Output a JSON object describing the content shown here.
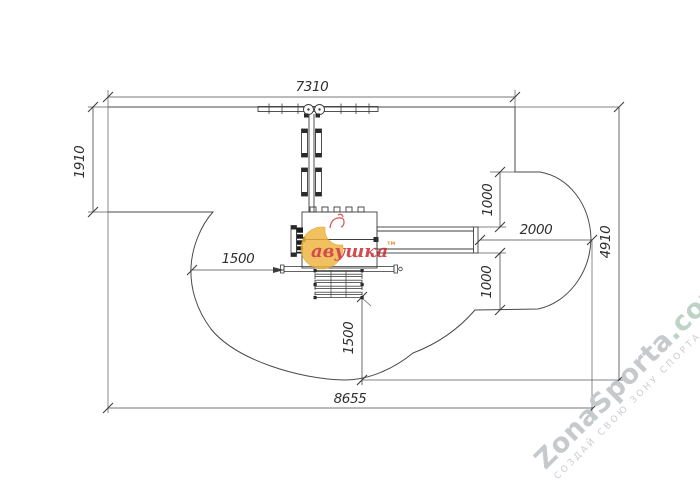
{
  "dims": {
    "top_width": "7310",
    "left_height": "1910",
    "left_clearance": "1500",
    "slide_clearance": "2000",
    "right_upper": "1000",
    "right_lower": "1000",
    "right_height": "4910",
    "bottom_clearance": "1500",
    "bottom_width": "8655"
  },
  "brand": {
    "text": "авушка",
    "tm": "тм"
  },
  "zona": {
    "name": "ZonaSporta",
    "domain": ".com",
    "tagline": "СОЗДАЙ СВОЮ ЗОНУ СПОРТА"
  },
  "colors": {
    "drawing_line": "#4a4a4a",
    "brand_crescent": "#eeb43c",
    "brand_text": "#c8242b",
    "zona_name": "#c4c8cb",
    "zona_domain": "#bad1c3"
  }
}
